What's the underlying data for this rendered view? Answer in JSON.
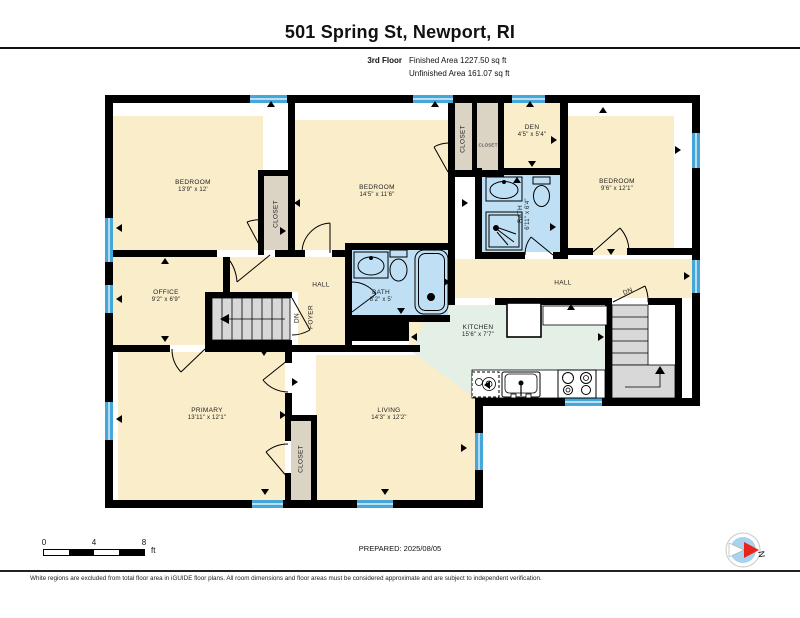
{
  "header": {
    "title": "501 Spring St, Newport, RI",
    "floor_label": "3rd Floor",
    "finished_area": "Finished Area 1227.50 sq ft",
    "unfinished_area": "Unfinished Area 161.07 sq ft"
  },
  "rooms": {
    "bedroom1": {
      "name": "BEDROOM",
      "dims": "13'9\" x 12'"
    },
    "bedroom2": {
      "name": "BEDROOM",
      "dims": "14'5\" x 11'6\""
    },
    "bedroom3": {
      "name": "BEDROOM",
      "dims": "9'6\" x 12'1\""
    },
    "den": {
      "name": "DEN",
      "dims": "4'5\" x 5'4\""
    },
    "office": {
      "name": "OFFICE",
      "dims": "9'2\" x 6'9\""
    },
    "primary": {
      "name": "PRIMARY",
      "dims": "13'11\" x 12'1\""
    },
    "living": {
      "name": "LIVING",
      "dims": "14'3\" x 12'2\""
    },
    "kitchen": {
      "name": "KITCHEN",
      "dims": "15'6\" x 7'7\""
    },
    "bath_main": {
      "name": "BATH",
      "dims": "8'2\" x 5'"
    },
    "bath_second": {
      "name": "BATH",
      "dims": "6'11\" x 6'4\""
    },
    "hall": {
      "name": "HALL"
    },
    "foyer": {
      "name": "FOYER"
    },
    "closet": {
      "name": "CLOSET"
    },
    "stairs_down": {
      "name": "DN"
    }
  },
  "scale_bar": {
    "tick0": "0",
    "tick4": "4",
    "tick8": "8",
    "unit": "ft"
  },
  "compass": {
    "north_label": "N"
  },
  "footer": {
    "prepared": "PREPARED: 2025/08/05",
    "disclaimer": "White regions are excluded from total floor area in iGUIDE floor plans. All room dimensions and floor areas must be considered approximate and are subject to independent verification."
  },
  "colors": {
    "room_fill": "#FAEDCA",
    "closet_fill": "#DBD4C5",
    "bath_fill": "#BFE0F4",
    "kitchen_fill": "#E4EFE6",
    "stairs_fill": "#D8D8D8",
    "window_blue": "#45A6D9",
    "wall": "#000000",
    "compass_fill": "#A8D2EE",
    "compass_needle": "#E8251B"
  }
}
